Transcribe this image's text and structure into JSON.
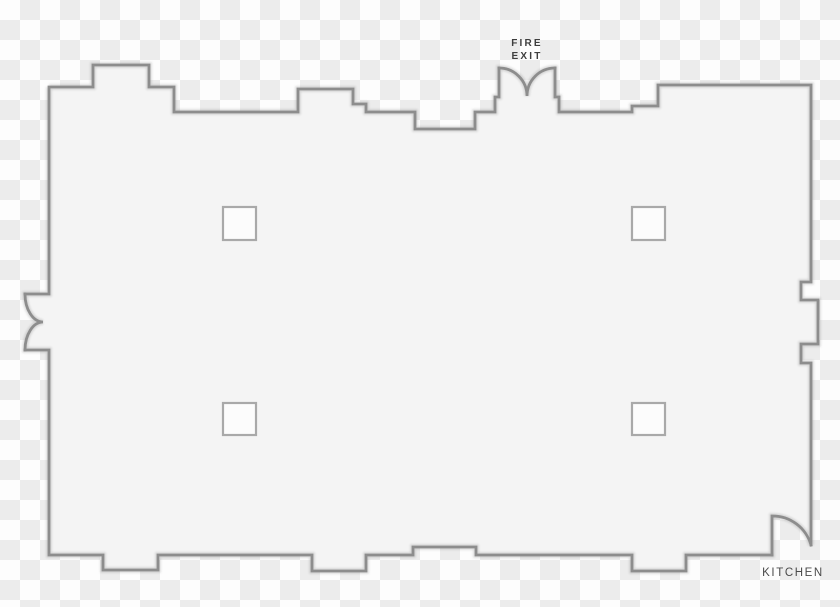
{
  "title": "Event space floor plan with fire exit and kitchen",
  "labels": {
    "fire_exit": {
      "line1": "FIRE",
      "line2": "EXIT"
    },
    "kitchen": "KITCHEN"
  },
  "features": {
    "pillar_count": 4,
    "doors": [
      "fire-exit double door (top)",
      "double door (left wall)",
      "kitchen door (bottom right)"
    ]
  },
  "colors": {
    "wall": "#8d8d8d",
    "room_fill": "#f4f4f4",
    "pillar_fill": "#fcfcfc",
    "pillar_border": "#a9a9a9",
    "checker_light": "#fdfdfd",
    "checker_dark": "#ececec",
    "fire_exit_text": "#3e3e3e",
    "kitchen_text": "#4a4a4a"
  }
}
